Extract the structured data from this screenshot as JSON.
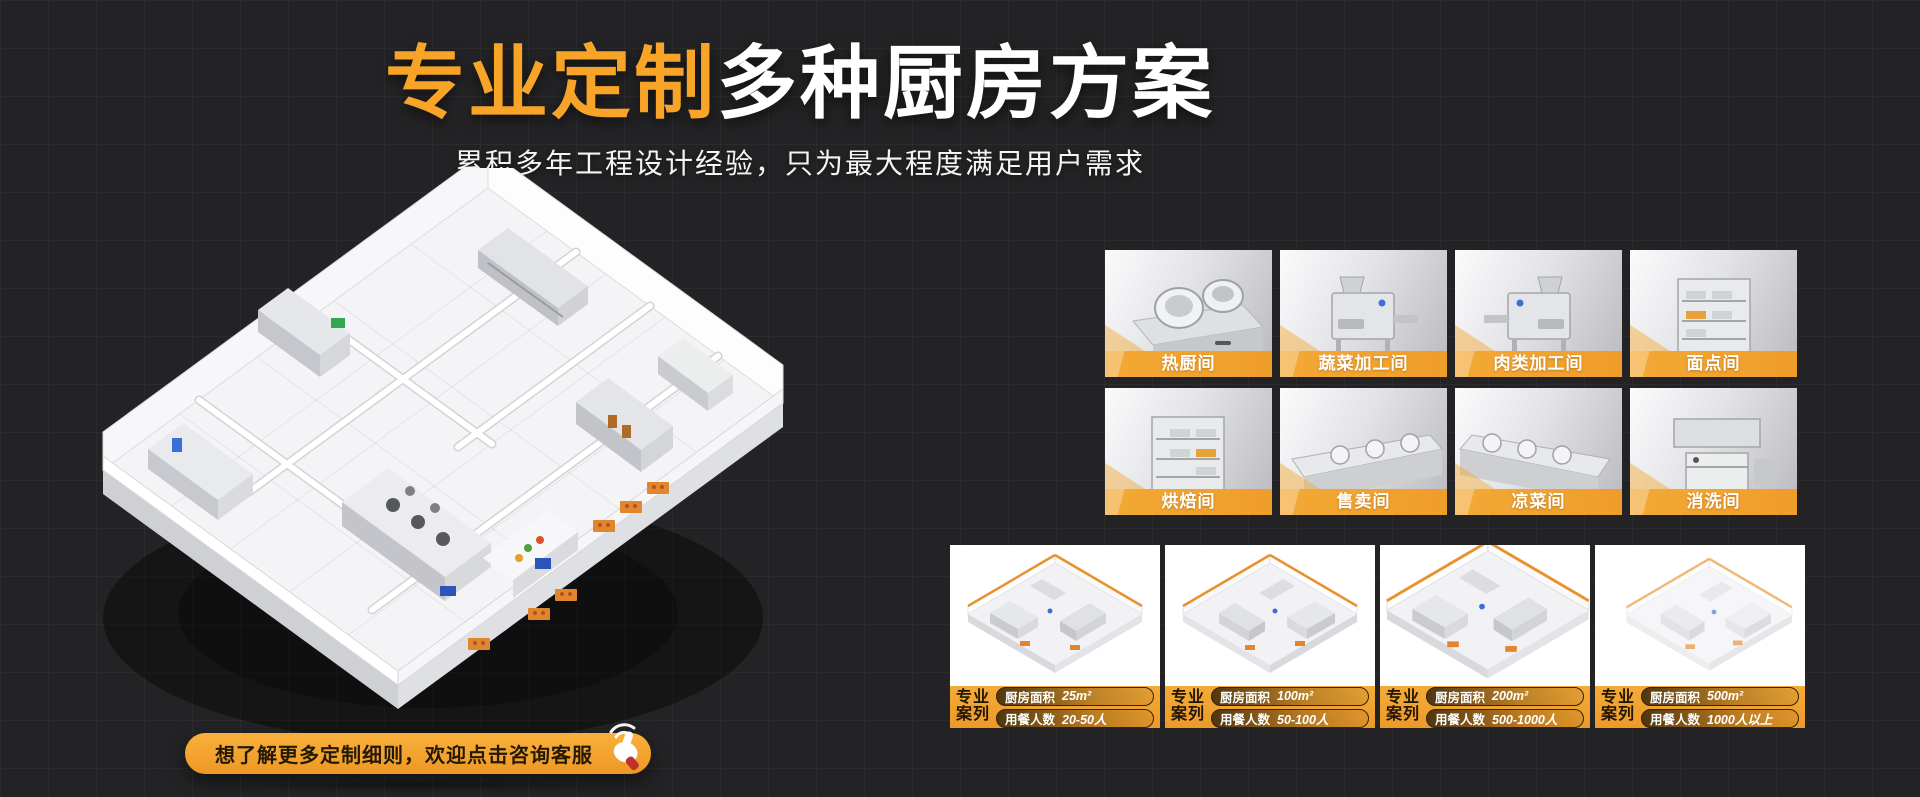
{
  "header": {
    "title_highlight": "专业定制",
    "title_rest": "多种厨房方案",
    "subtitle": "累积多年工程设计经验，只为最大程度满足用户需求"
  },
  "rooms": [
    {
      "label": "热厨间"
    },
    {
      "label": "蔬菜加工间"
    },
    {
      "label": "肉类加工间"
    },
    {
      "label": "面点间"
    },
    {
      "label": "烘焙间"
    },
    {
      "label": "售卖间"
    },
    {
      "label": "凉菜间"
    },
    {
      "label": "消洗间"
    }
  ],
  "cases": [
    {
      "badge_line1": "专业",
      "badge_line2": "案列",
      "area_label": "厨房面积",
      "area_value": "25m²",
      "people_label": "用餐人数",
      "people_value": "20-50人"
    },
    {
      "badge_line1": "专业",
      "badge_line2": "案列",
      "area_label": "厨房面积",
      "area_value": "100m²",
      "people_label": "用餐人数",
      "people_value": "50-100人"
    },
    {
      "badge_line1": "专业",
      "badge_line2": "案列",
      "area_label": "厨房面积",
      "area_value": "200m²",
      "people_label": "用餐人数",
      "people_value": "500-1000人"
    },
    {
      "badge_line1": "专业",
      "badge_line2": "案列",
      "area_label": "厨房面积",
      "area_value": "500m²",
      "people_label": "用餐人数",
      "people_value": "1000人以上"
    }
  ],
  "cta": {
    "label": "想了解更多定制细则，欢迎点击咨询客服",
    "icon": "hand-click-icon"
  },
  "colors": {
    "accent": "#F7A428",
    "accent_deep": "#EE9A2B",
    "background": "#232325"
  }
}
